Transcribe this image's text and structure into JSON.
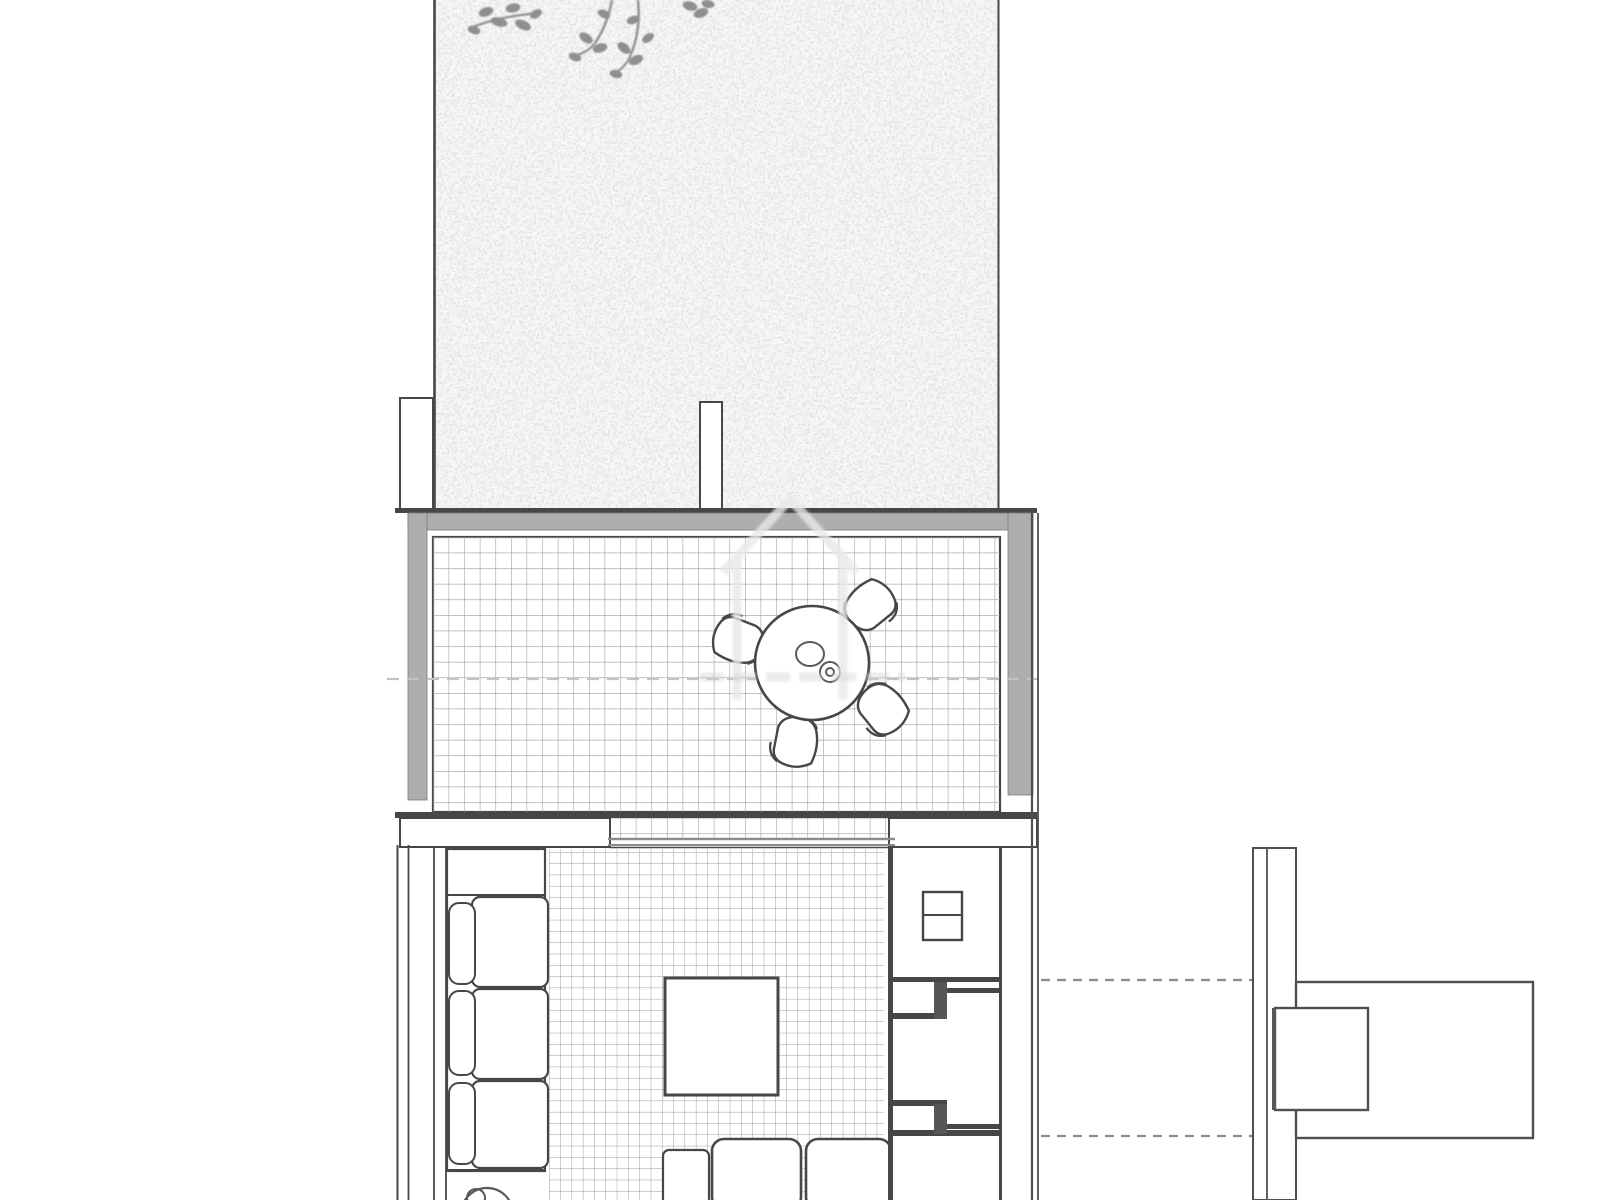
{
  "title": "Ground floor plan with garden, tiled terrace and living room",
  "colors": {
    "paper": "#ffffff",
    "line": "#474747",
    "soft_line": "#8b8b8b",
    "wall_gray": "#aeaeae",
    "grid_line": "#9c9c9c",
    "stipple": "#c8c8c8",
    "garden_bg": "#f6f6f6",
    "faint_line": "#c3c3c3",
    "watermark": "#e8e8e8"
  },
  "plan": {
    "garden": {
      "label": "garden",
      "surface": "stippled lawn",
      "elements": [
        "overhanging tree branches",
        "left boundary wall",
        "gate pillar left",
        "gate pillar right"
      ]
    },
    "terrace": {
      "label": "tiled terrace",
      "surface": "square tile grid",
      "elements": [
        "gray parapet walls",
        "round dining table",
        "table centerpiece",
        "chair north-east",
        "chair west",
        "chair south-east",
        "chair south",
        "section line",
        "sliding door track"
      ]
    },
    "living_room": {
      "label": "living room",
      "surface": "gridded rug",
      "elements": [
        "three-seat sofa with back cushions",
        "coffee table",
        "floor sofa cushions at bottom",
        "round planter"
      ]
    },
    "hallway": {
      "label": "entry hallway",
      "elements": [
        "wall cabinet with divider",
        "upper door jamb",
        "lower door jamb",
        "partition wall"
      ]
    },
    "annex": {
      "label": "detached annex",
      "elements": [
        "vertical boundary wall",
        "annex room rectangle",
        "annex pier square",
        "upper dashed connection line",
        "lower dashed connection line"
      ]
    }
  },
  "watermark": {
    "shape": "house outline",
    "style": "faint gray translucent"
  }
}
